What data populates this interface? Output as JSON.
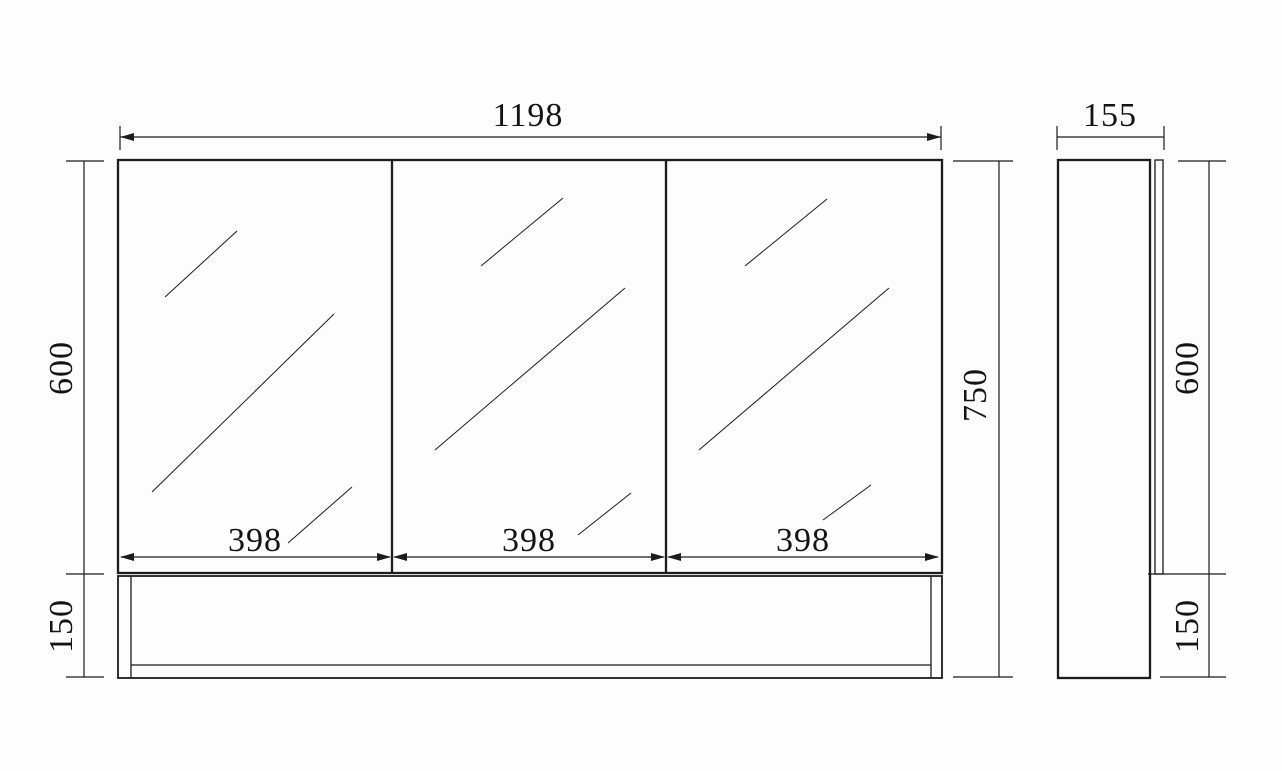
{
  "drawing_title": "mirror-cabinet-dimension-drawing",
  "colors": {
    "background": "#fdfdfd",
    "line": "#1c1c1c",
    "text": "#141414"
  },
  "front_view": {
    "overall_width": "1198",
    "total_height": "750",
    "mirror_height": "600",
    "shelf_height": "150",
    "doors": [
      {
        "width": "398"
      },
      {
        "width": "398"
      },
      {
        "width": "398"
      }
    ]
  },
  "side_view": {
    "depth": "155",
    "mirror_height": "600",
    "shelf_height": "150"
  }
}
